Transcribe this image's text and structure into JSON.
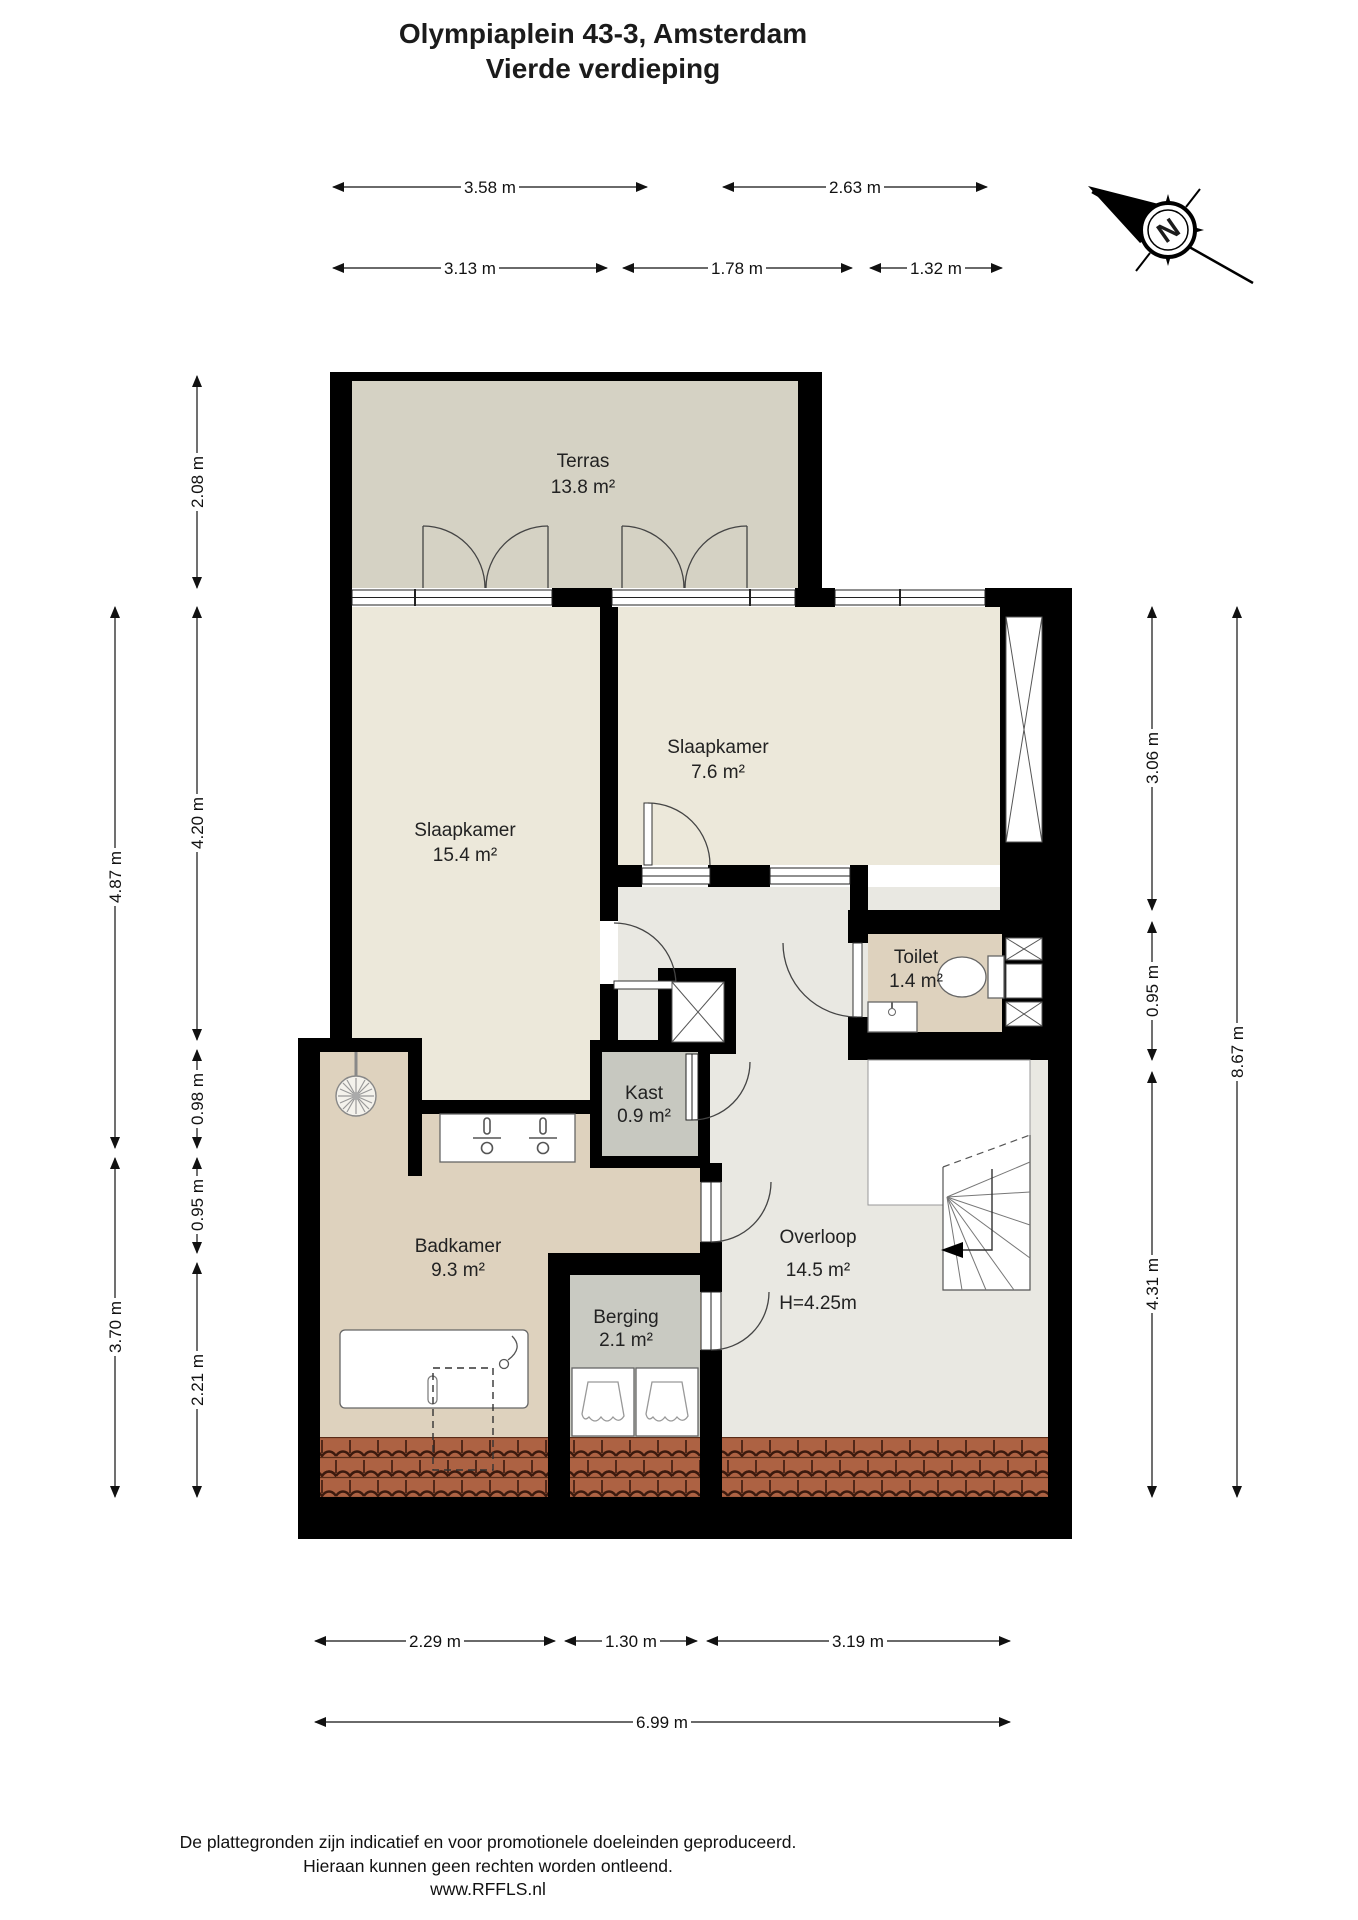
{
  "title": {
    "line1": "Olympiaplein 43-3, Amsterdam",
    "line2": "Vierde verdieping"
  },
  "compass": {
    "label": "N"
  },
  "rooms": {
    "terras": {
      "name": "Terras",
      "area": "13.8 m²"
    },
    "slaapkamer1": {
      "name": "Slaapkamer",
      "area": "15.4 m²"
    },
    "slaapkamer2": {
      "name": "Slaapkamer",
      "area": "7.6 m²"
    },
    "toilet": {
      "name": "Toilet",
      "area": "1.4 m²"
    },
    "kast": {
      "name": "Kast",
      "area": "0.9 m²"
    },
    "badkamer": {
      "name": "Badkamer",
      "area": "9.3 m²"
    },
    "berging": {
      "name": "Berging",
      "area": "2.1 m²"
    },
    "overloop": {
      "name": "Overloop",
      "area": "14.5 m²",
      "height": "H=4.25m"
    }
  },
  "dimensions": {
    "top_row1": [
      "3.58 m",
      "2.63 m"
    ],
    "top_row2": [
      "3.13 m",
      "1.78 m",
      "1.32 m"
    ],
    "left_outer": [
      "4.87 m",
      "3.70 m"
    ],
    "left_inner": [
      "2.08 m",
      "4.20 m",
      "0.98 m",
      "0.95 m",
      "2.21 m"
    ],
    "right_inner": [
      "3.06 m",
      "0.95 m",
      "4.31 m"
    ],
    "right_outer": [
      "8.67 m"
    ],
    "bottom_row1": [
      "2.29 m",
      "1.30 m",
      "3.19 m"
    ],
    "bottom_row2": [
      "6.99 m"
    ]
  },
  "footer": {
    "line1": "De plattegronden zijn indicatief en voor promotionele doeleinden geproduceerd.",
    "line2": "Hieraan kunnen geen rechten worden ontleend.",
    "line3": "www.RFFLS.nl"
  },
  "colors": {
    "wall": "#000000",
    "terras_floor": "#d5d2c4",
    "bedroom_floor": "#ece8da",
    "wet_floor": "#ded2be",
    "hall_floor": "#e9e8e2",
    "closet_floor": "#c7c8c0",
    "storage_floor": "#c9cac2",
    "roof_tiles": "#a96040"
  }
}
